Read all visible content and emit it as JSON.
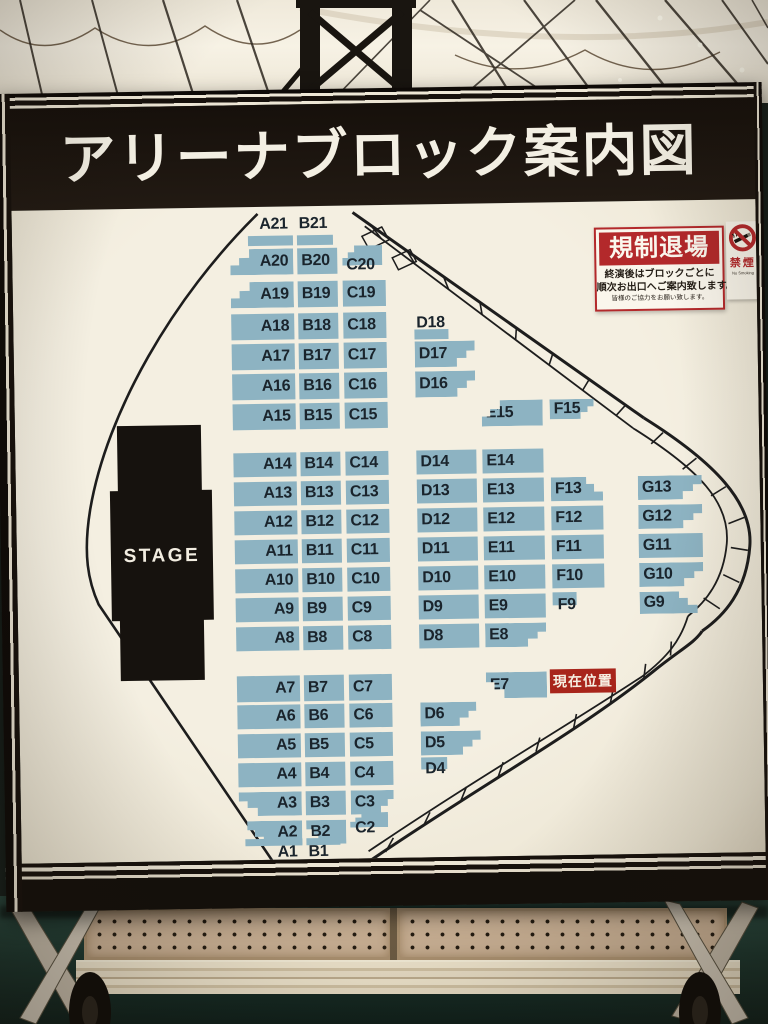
{
  "title": "アリーナブロック案内図",
  "map": {
    "stage_label": "STAGE",
    "current_location_label": "現在位置",
    "blocks": [
      "A21",
      "B21",
      "A20",
      "B20",
      "C20",
      "A19",
      "B19",
      "C19",
      "A18",
      "B18",
      "C18",
      "D18",
      "A17",
      "B17",
      "C17",
      "D17",
      "A16",
      "B16",
      "C16",
      "D16",
      "A15",
      "B15",
      "C15",
      "E15",
      "F15",
      "A14",
      "B14",
      "C14",
      "D14",
      "E14",
      "A13",
      "B13",
      "C13",
      "D13",
      "E13",
      "F13",
      "G13",
      "A12",
      "B12",
      "C12",
      "D12",
      "E12",
      "F12",
      "G12",
      "A11",
      "B11",
      "C11",
      "D11",
      "E11",
      "F11",
      "G11",
      "A10",
      "B10",
      "C10",
      "D10",
      "E10",
      "F10",
      "G10",
      "A9",
      "B9",
      "C9",
      "D9",
      "E9",
      "F9",
      "G9",
      "A8",
      "B8",
      "C8",
      "D8",
      "E8",
      "A7",
      "B7",
      "C7",
      "E7",
      "A6",
      "B6",
      "C6",
      "D6",
      "A5",
      "B5",
      "C5",
      "D5",
      "A4",
      "B4",
      "C4",
      "D4",
      "A3",
      "B3",
      "C3",
      "A2",
      "B2",
      "C2",
      "A1",
      "B1"
    ]
  },
  "exit_sign": {
    "heading": "規制退場",
    "line1": "終演後はブロックごとに",
    "line2": "順次お出口へご案内致します。",
    "line3": "皆様のご協力をお願い致します。"
  },
  "no_smoking_sign": {
    "label": "禁煙",
    "sublabel": "No Smoking"
  },
  "colors": {
    "block_fill": "#8db3c2",
    "map_background": "#f2ecdd",
    "frame_black": "#17110c",
    "alert_red": "#b3292b",
    "location_red": "#a8251b"
  }
}
